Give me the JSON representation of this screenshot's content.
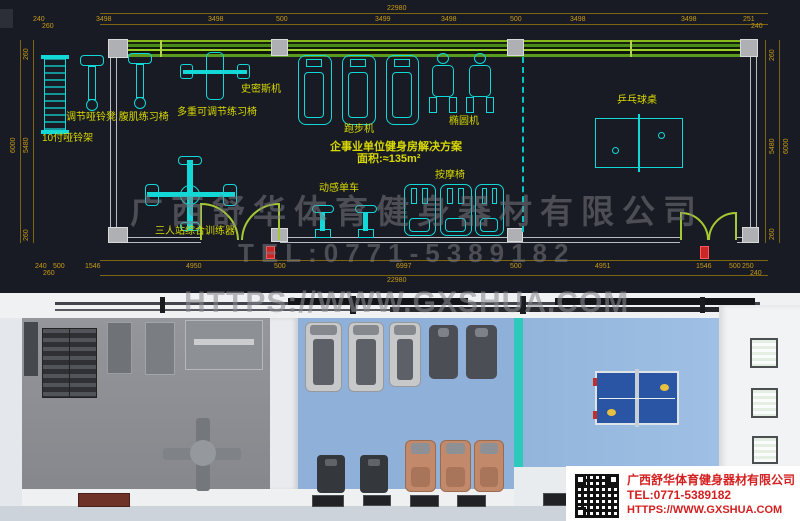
{
  "watermark": {
    "company": "广西舒华体育健身器材有限公司",
    "tel": "TEL:0771-5389182",
    "url": "HTTPS://WWW.GXSHUA.COM"
  },
  "cad": {
    "total_width_top": "22980",
    "total_width_bottom": "22980",
    "top_dims": [
      "240",
      "3498",
      "3498",
      "500",
      "3499",
      "3498",
      "500",
      "3498",
      "3498",
      "251"
    ],
    "top_sub_left": "260",
    "top_sub_right": "240",
    "bottom_dims": [
      "240",
      "500",
      "1546",
      "4950",
      "500",
      "6997",
      "500",
      "4951",
      "1546",
      "500",
      "250"
    ],
    "bottom_sub_left": "260",
    "bottom_sub_right": "240",
    "left_dims": [
      "260",
      "5480",
      "6000",
      "260"
    ],
    "right_dims": [
      "260",
      "5480",
      "6000",
      "260"
    ],
    "labels": {
      "dumbbell_rack": "10付哑铃架",
      "benches": "调节哑铃凳 腹肌练习椅",
      "multi_bench": "多重可调节练习椅",
      "smith_machine": "史密斯机",
      "treadmill": "跑步机",
      "elliptical": "椭圆机",
      "table_tennis": "乒乓球桌",
      "spin_bike": "动感单车",
      "massage_chair": "按摩椅",
      "multi_trainer": "三人站综合训练器"
    },
    "title": "企事业单位健身房解决方案",
    "area": "面积:≈135m²"
  },
  "info_box": {
    "company": "广西舒华体育健身器材有限公司",
    "tel": "TEL:0771-5389182",
    "url": "HTTPS://WWW.GXSHUA.COM"
  },
  "colors": {
    "cad_background": "#181b23",
    "dimension_text": "#c89b18",
    "equipment_outline": "#12d8d8",
    "label_yellow": "#d9d900",
    "wall_green": "#86b81e",
    "door_green": "#a6c832",
    "partition_teal": "#00c6c6",
    "floor_gray": "#8e9096",
    "floor_blue": "#8fb1d9",
    "partition_3d": "#2ec9bd",
    "massage_tan": "#c2896a",
    "info_red": "#d42020",
    "watermark_gray": "#7a7a80"
  }
}
